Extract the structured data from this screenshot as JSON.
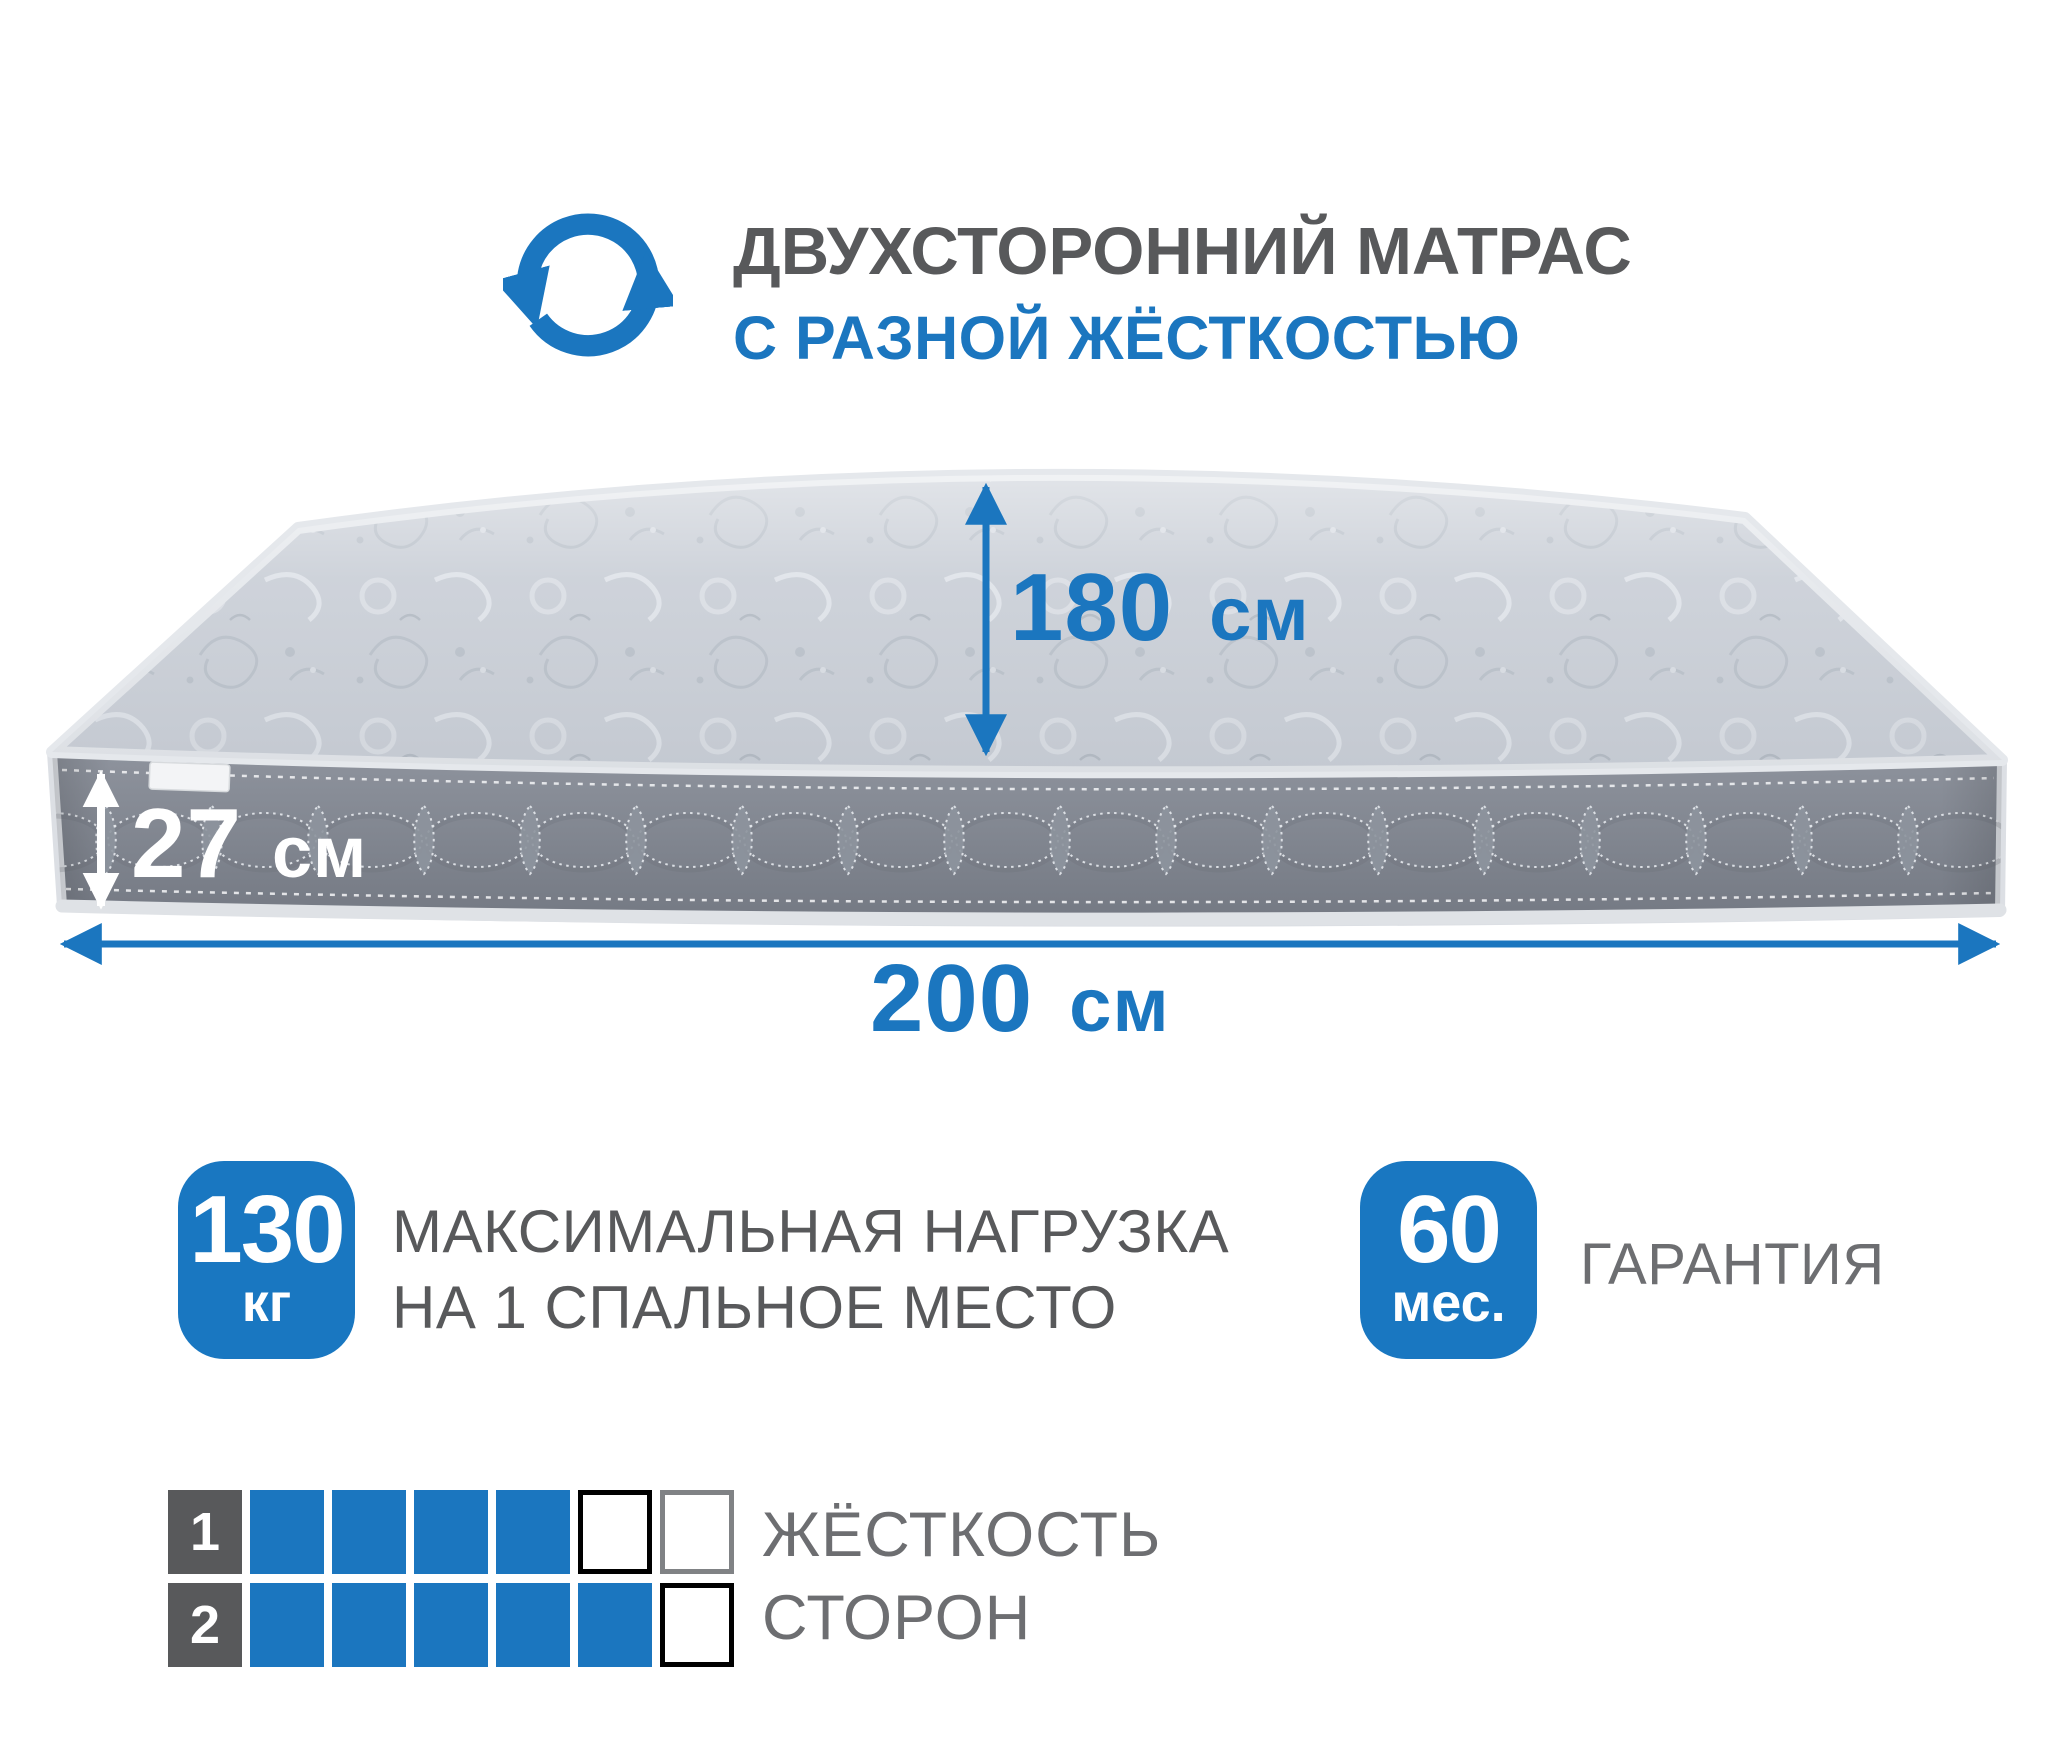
{
  "header": {
    "title": "ДВУХСТОРОННИЙ МАТРАС",
    "subtitle": "С РАЗНОЙ ЖЁСТКОСТЬЮ",
    "icon": "rotate-arrows-icon"
  },
  "colors": {
    "accent": "#1b76bf",
    "badge_blue": "#1977c1",
    "title_gray": "#58595b",
    "caption_gray": "#6d6e71",
    "mattress_top": "#cacfd7",
    "mattress_side": "#81868f",
    "piping": "#e2e5ea"
  },
  "dimensions": {
    "depth_label": {
      "value": "180",
      "unit": "см"
    },
    "thickness_label": {
      "value": "27",
      "unit": "см"
    },
    "width_label": {
      "value": "200",
      "unit": "см"
    }
  },
  "badges": [
    {
      "value": "130",
      "unit": "кг",
      "label_lines": [
        "МАКСИМАЛЬНАЯ НАГРУЗКА",
        "НА 1 СПАЛЬНОЕ МЕСТО"
      ]
    },
    {
      "value": "60",
      "unit": "мес.",
      "label_lines": [
        "ГАРАНТИЯ"
      ]
    }
  ],
  "hardness_scale": {
    "filled_color": "#1b76bf",
    "rows": [
      {
        "label": "1",
        "filled": 4,
        "total": 6,
        "empty_border_colors": [
          "#000000",
          "#808285"
        ]
      },
      {
        "label": "2",
        "filled": 5,
        "total": 6,
        "empty_border_colors": [
          "#000000"
        ]
      }
    ],
    "caption_lines": [
      "ЖЁСТКОСТЬ",
      "СТОРОН"
    ]
  }
}
